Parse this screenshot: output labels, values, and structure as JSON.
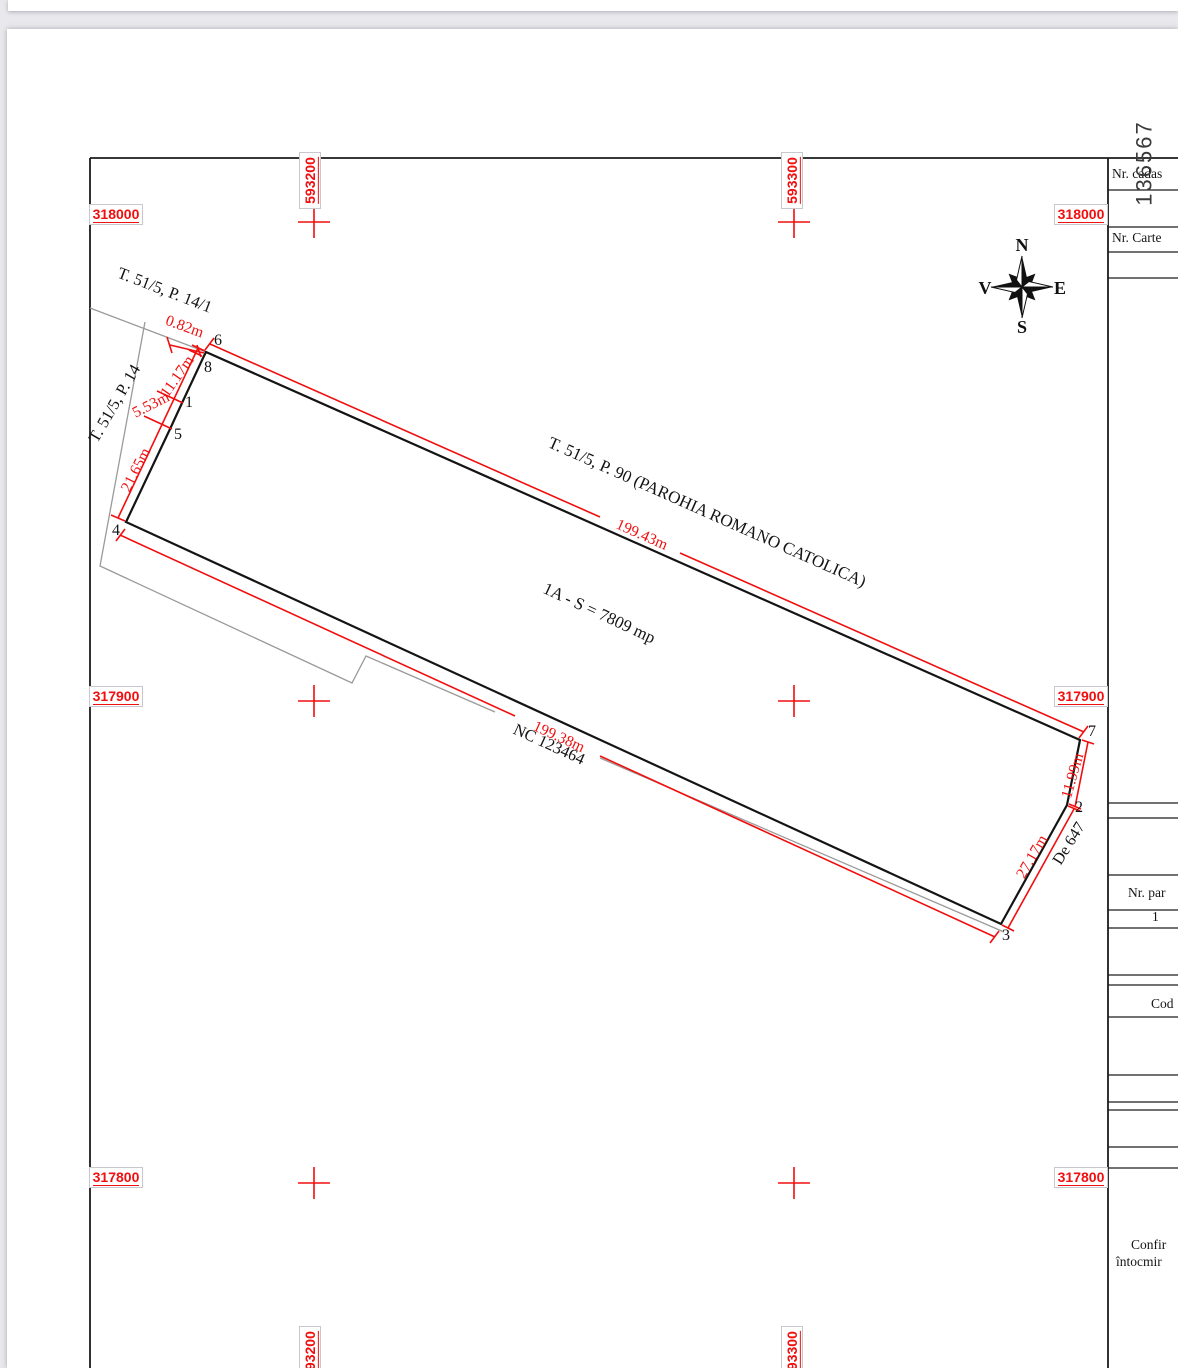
{
  "doc": {
    "number": "136567"
  },
  "grid": {
    "rows": [
      {
        "label": "318000"
      },
      {
        "label": "317900"
      },
      {
        "label": "317800"
      }
    ],
    "cols": [
      {
        "label": "593200"
      },
      {
        "label": "593300"
      }
    ]
  },
  "drawing": {
    "neighbor_top": "T. 51/5, P. 90 (PAROHIA ROMANO  CATOLICA)",
    "neighbor_left_upper": "T. 51/5, P. 14/1",
    "neighbor_left_lower": "T. 51/5, P. 14",
    "road_label": "De 647",
    "parcel_label": "1A - S = 7809 mp",
    "nc_label": "NC 123464",
    "dims": {
      "top": "199.43m",
      "bottom": "199.38m",
      "seg68": "0.82m",
      "seg81": "11.17m",
      "seg15": "5.53m",
      "seg54": "21.65m",
      "seg72": "11.99m",
      "seg23": "27.17m"
    },
    "points": {
      "p1": "1",
      "p2": "2",
      "p3": "3",
      "p4": "4",
      "p5": "5",
      "p6": "6",
      "p7": "7",
      "p8": "8"
    }
  },
  "compass": {
    "north": "N",
    "south": "S",
    "east": "E",
    "west": "V"
  },
  "table": {
    "nr_cadastral": "Nr. cadas",
    "nr_carte": "Nr. Carte",
    "nr_parcela": "Nr. par",
    "parcela_value": "1",
    "cod": "Cod",
    "confirm_line1": "Confir",
    "confirm_line2": "întocmir"
  },
  "colors": {
    "accent_red": "#f10e0e",
    "line_black": "#141414",
    "line_gray": "#9a9a9a"
  }
}
